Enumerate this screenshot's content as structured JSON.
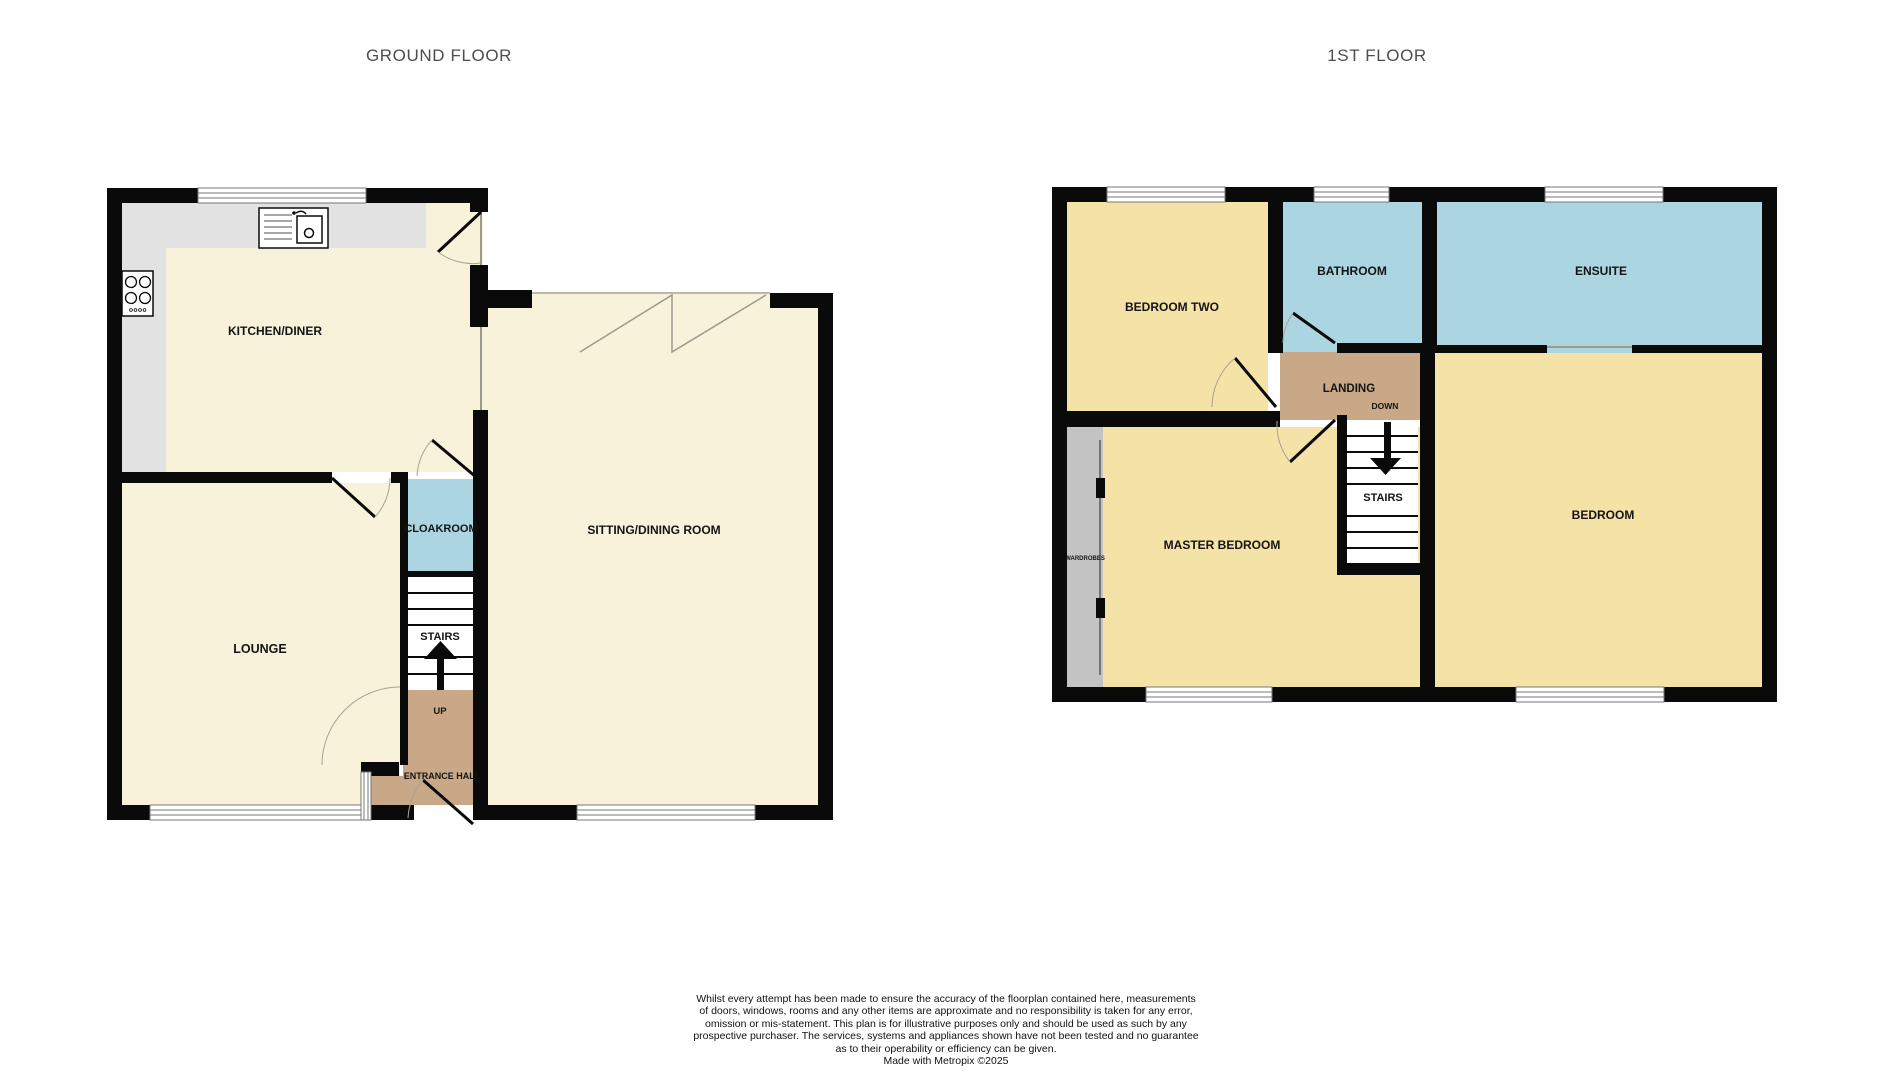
{
  "titles": {
    "ground": "GROUND FLOOR",
    "first": "1ST FLOOR"
  },
  "ground_floor": {
    "rooms": {
      "kitchen": "KITCHEN/DINER",
      "lounge": "LOUNGE",
      "cloakroom": "CLOAKROOM",
      "stairs": "STAIRS",
      "up": "UP",
      "entrance": "ENTRANCE HALL",
      "sitting": "SITTING/DINING ROOM"
    }
  },
  "first_floor": {
    "rooms": {
      "bedroom_two": "BEDROOM TWO",
      "bathroom": "BATHROOM",
      "ensuite": "ENSUITE",
      "landing": "LANDING",
      "down": "DOWN",
      "stairs": "STAIRS",
      "master": "MASTER BEDROOM",
      "bedroom": "BEDROOM",
      "wardrobes": "WARDROBES"
    }
  },
  "disclaimer": {
    "lines": [
      "Whilst every attempt has been made to ensure the accuracy of the floorplan contained here, measurements",
      "of doors, windows, rooms and any other items are approximate and no responsibility is taken for any error,",
      "omission or mis-statement. This plan is for illustrative purposes only and should be used as such by any",
      "prospective purchaser. The services, systems and appliances shown have not been tested and no guarantee",
      "as to their operability or efficiency can be given.",
      "Made with Metropix ©2025"
    ]
  },
  "colors": {
    "wall": "#0a0a0a",
    "ground_room": "#f8f2da",
    "first_room": "#f5e2a6",
    "wet_room": "#abd5e0",
    "hall_tan": "#c8a887",
    "counter_grey": "#e2e2e2",
    "wardrobe_grey": "#c3c3c3",
    "title_grey": "#4d4d4d"
  }
}
